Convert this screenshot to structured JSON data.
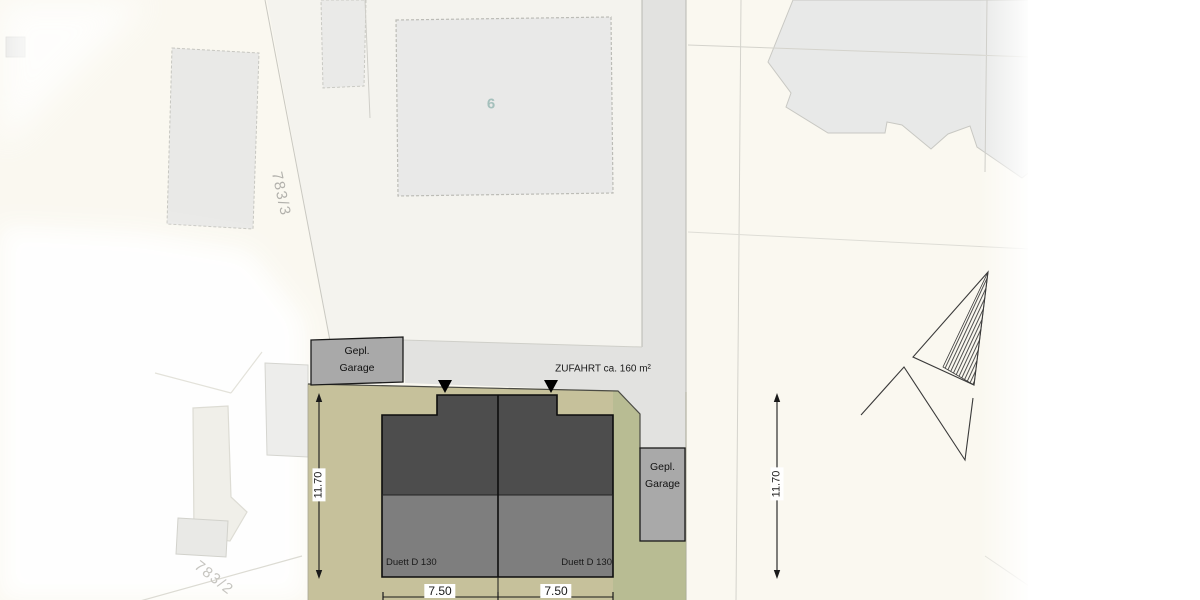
{
  "plan": {
    "title_hint": "site plan with planned duplex house",
    "parcels": {
      "top_label": "783/3",
      "bottom_label": "783/2"
    },
    "existing_building": {
      "house_number": "6"
    },
    "driveway": {
      "label": "ZUFAHRT ca. 160 m²"
    },
    "garage_left": {
      "line1": "Gepl.",
      "line2": "Garage"
    },
    "garage_right": {
      "line1": "Gepl.",
      "line2": "Garage"
    },
    "house": {
      "unit_left_label": "Duett D 130",
      "unit_right_label": "Duett D 130"
    },
    "dimensions": {
      "left_vertical": "11.70",
      "right_vertical": "11.70",
      "bottom_left": "7.50",
      "bottom_right": "7.50"
    },
    "colors": {
      "background_paper": "#faf8f0",
      "parcel_fill": "#f4f3ee",
      "road_fill": "#e2e2e0",
      "plot_olive": "#c6c19b",
      "plot_green_overlay": "#a9b88c",
      "garage_gray": "#a9a9a9",
      "house_dark": "#4d4d4d",
      "house_light": "#7e7e7e",
      "existing_building_fill": "#e8e9e8",
      "house_number_teal": "#a5c0bc",
      "line_black": "#1a1a1a"
    }
  }
}
